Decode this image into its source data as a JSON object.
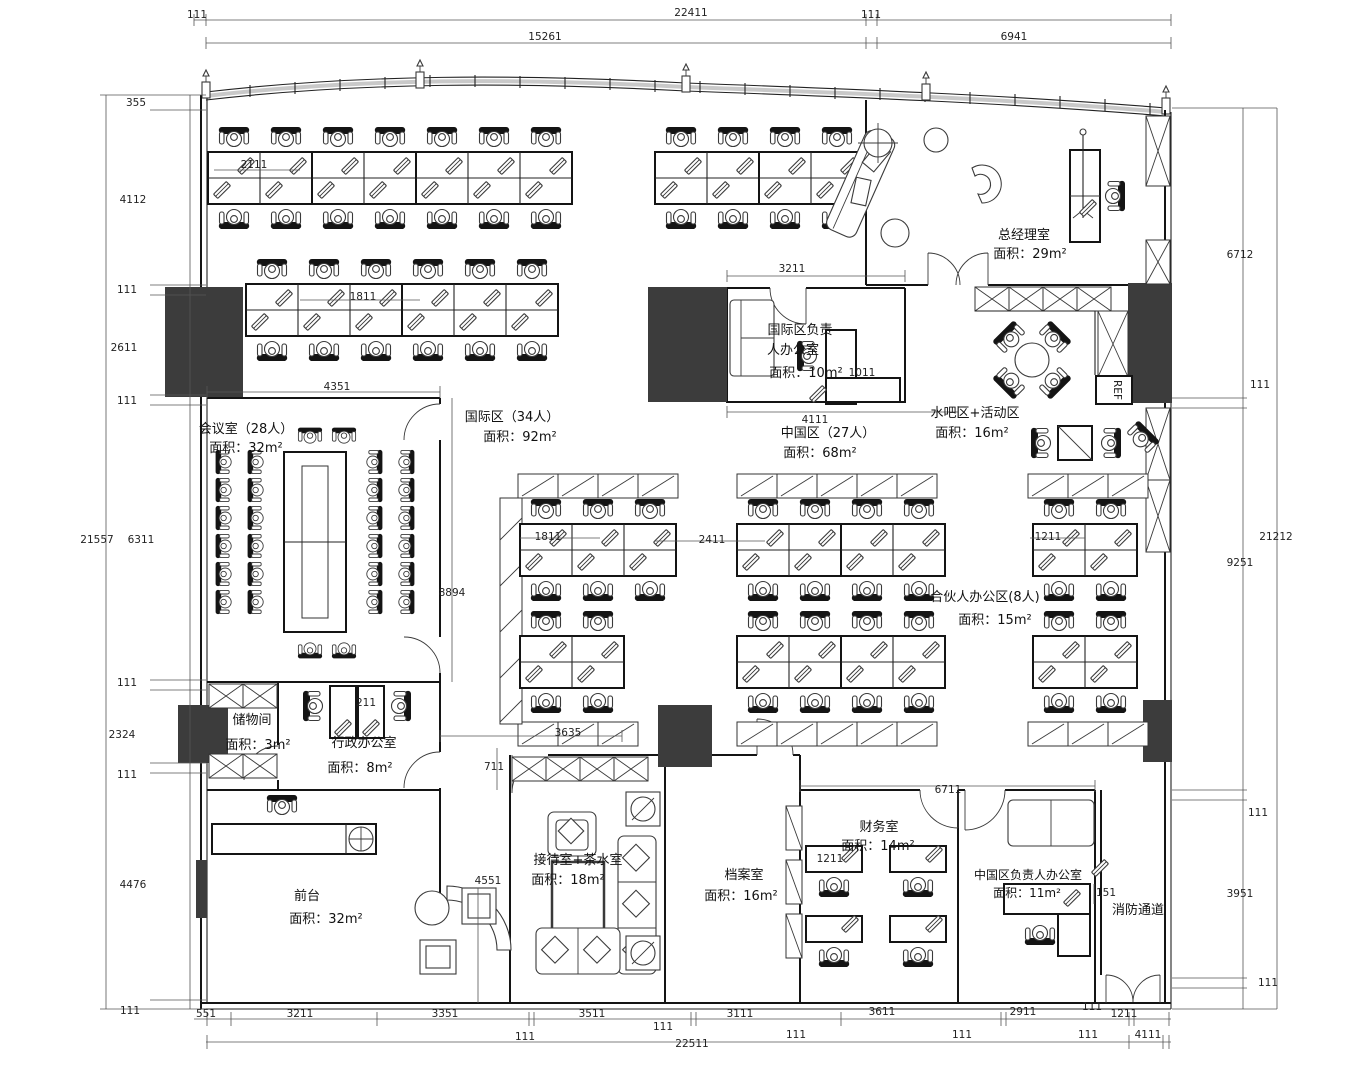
{
  "plan": {
    "rooms": {
      "gm": {
        "name": "总经理室",
        "area": "面积：29m²"
      },
      "intl_mgr": {
        "name_l1": "国际区负责",
        "name_l2": "人办公室",
        "area": "面积：10m²"
      },
      "waterbar": {
        "name": "水吧区+活动区",
        "area": "面积：16m²"
      },
      "intl_zone": {
        "name": "国际区（34人）",
        "area": "面积：92m²"
      },
      "china_zone": {
        "name": "中国区（27人）",
        "area": "面积：68m²"
      },
      "meeting": {
        "name": "会议室（28人）",
        "area": "面积：32m²"
      },
      "storage": {
        "name": "储物间",
        "area": "面积：3m²"
      },
      "admin": {
        "name": "行政办公室",
        "area": "面积：8m²"
      },
      "front_desk": {
        "name": "前台",
        "area": "面积：32m²"
      },
      "waiting": {
        "name": "接待室+茶水室",
        "area": "面积：18m²"
      },
      "archive": {
        "name": "档案室",
        "area": "面积：16m²"
      },
      "finance": {
        "name": "财务室",
        "area": "面积：14m²"
      },
      "china_mgr": {
        "name": "中国区负责人办公室",
        "area": "面积：11m²"
      },
      "partner": {
        "name": "合伙人办公区(8人)",
        "area": "面积：15m²"
      },
      "fire": {
        "name": "消防通道"
      }
    },
    "appliances": {
      "fridge": "REF"
    },
    "dims": {
      "top": {
        "d111a": "111",
        "d22411": "22411",
        "d111b": "111",
        "d15261": "15261",
        "d6941": "6941"
      },
      "left": {
        "d355": "355",
        "d4112": "4112",
        "d111a": "111",
        "d2611": "2611",
        "d111b": "111",
        "d21557": "21557",
        "d6311": "6311",
        "d111c": "111",
        "d2324": "2324",
        "d111d": "111",
        "d4476": "4476",
        "d111e": "111"
      },
      "right": {
        "d6712": "6712",
        "d111a": "111",
        "d21212": "21212",
        "d9251": "9251",
        "d111b": "111",
        "d3951": "3951",
        "d111c": "111"
      },
      "bottom": {
        "d551": "551",
        "d3211": "3211",
        "d3351": "3351",
        "d3511": "3511",
        "d111a": "111",
        "d3111": "3111",
        "d3611": "3611",
        "d2911": "2911",
        "d111b": "111",
        "d1211": "1211",
        "d111c": "111",
        "d22511": "22511",
        "d111d": "111",
        "d111e": "111",
        "d111f": "111",
        "d4111": "4111"
      },
      "inner": {
        "d3211": "3211",
        "d4111": "4111",
        "d1011": "1011",
        "d4351": "4351",
        "d8894": "8894",
        "d2111": "2111",
        "d1811a": "1811",
        "d1811b": "1811",
        "d2411": "2411",
        "d1211a": "1211",
        "d3635": "3635",
        "d711": "711",
        "d4551": "4551",
        "d1211b": "1211",
        "d6711": "6711",
        "d151": "151",
        "d211": "211"
      }
    }
  }
}
